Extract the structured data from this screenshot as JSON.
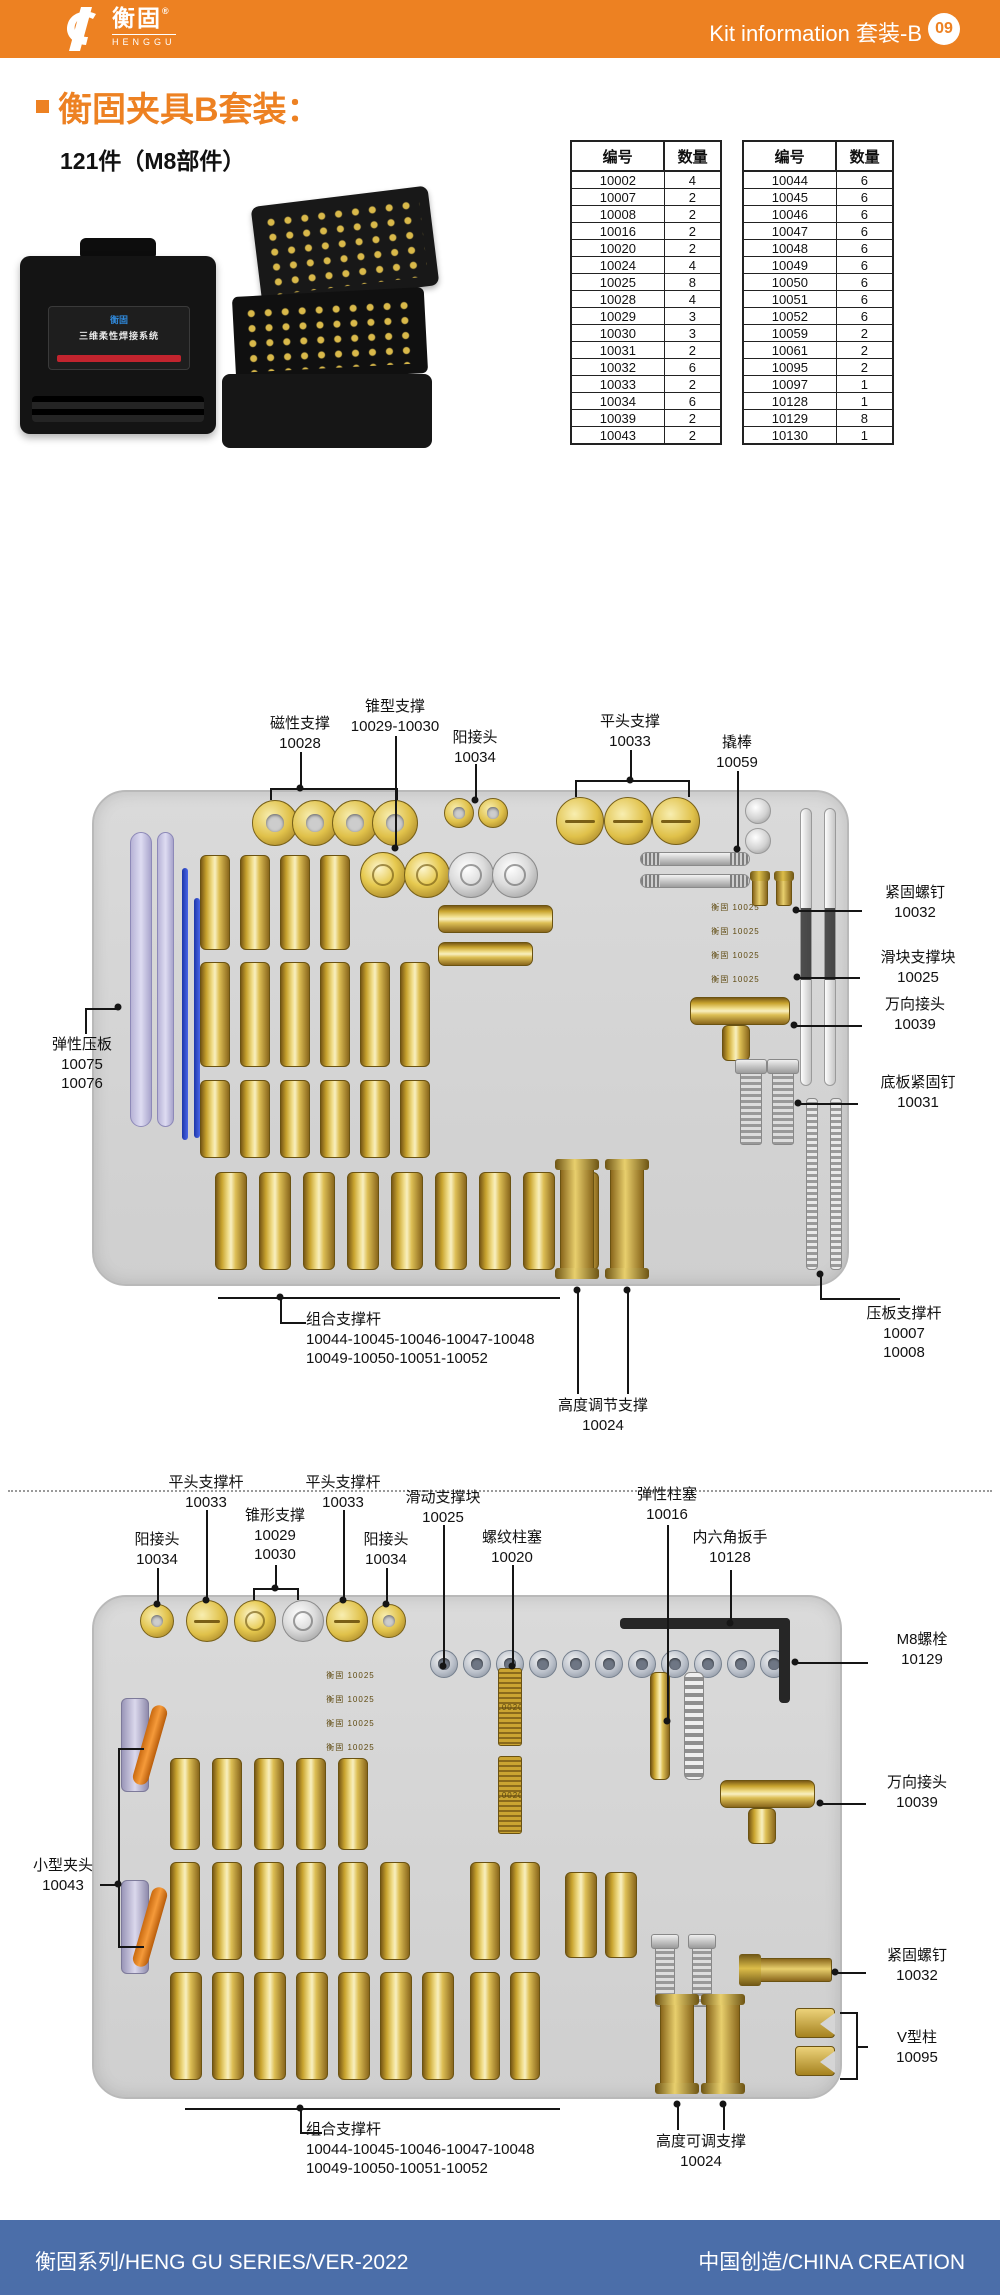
{
  "header": {
    "bg_color": "#ED8122",
    "brand_cn": "衡固",
    "registered_mark": "®",
    "brand_en": "HENGGU",
    "title": "Kit information 套装-B",
    "page_badge": "09"
  },
  "intro": {
    "accent_color": "#ED8122",
    "title": "衡固夹具B套装：",
    "subtitle": "121件（M8部件）"
  },
  "product_photos": {
    "closed_case_label": "三维柔性焊接系统"
  },
  "tables": {
    "headers": [
      "编号",
      "数量"
    ],
    "left_rows": [
      [
        "10002",
        "4"
      ],
      [
        "10007",
        "2"
      ],
      [
        "10008",
        "2"
      ],
      [
        "10016",
        "2"
      ],
      [
        "10020",
        "2"
      ],
      [
        "10024",
        "4"
      ],
      [
        "10025",
        "8"
      ],
      [
        "10028",
        "4"
      ],
      [
        "10029",
        "3"
      ],
      [
        "10030",
        "3"
      ],
      [
        "10031",
        "2"
      ],
      [
        "10032",
        "6"
      ],
      [
        "10033",
        "2"
      ],
      [
        "10034",
        "6"
      ],
      [
        "10039",
        "2"
      ],
      [
        "10043",
        "2"
      ]
    ],
    "right_rows": [
      [
        "10044",
        "6"
      ],
      [
        "10045",
        "6"
      ],
      [
        "10046",
        "6"
      ],
      [
        "10047",
        "6"
      ],
      [
        "10048",
        "6"
      ],
      [
        "10049",
        "6"
      ],
      [
        "10050",
        "6"
      ],
      [
        "10051",
        "6"
      ],
      [
        "10052",
        "6"
      ],
      [
        "10059",
        "2"
      ],
      [
        "10061",
        "2"
      ],
      [
        "10095",
        "2"
      ],
      [
        "10097",
        "1"
      ],
      [
        "10128",
        "1"
      ],
      [
        "10129",
        "8"
      ],
      [
        "10130",
        "1"
      ]
    ]
  },
  "diagram1": {
    "labels": {
      "magnetic": "磁性支撑\n10028",
      "cone": "锥型支撑\n10029-10030",
      "male_conn": "阳接头\n10034",
      "flat_head": "平头支撑\n10033",
      "pry_bar": "撬棒\n10059",
      "fasten_screw": "紧固螺钉\n10032",
      "slide_block": "滑块支撑块\n10025",
      "universal_joint": "万向接头\n10039",
      "base_pin": "底板紧固钉\n10031",
      "elastic_plate": "弹性压板\n10075\n10076",
      "combo_rod": "组合支撑杆\n10044-10045-10046-10047-10048\n10049-10050-10051-10052",
      "height_adjust": "高度调节支撑\n10024",
      "press_rod": "压板支撑杆\n10007\n10008"
    }
  },
  "diagram2": {
    "labels": {
      "flat_rod_1": "平头支撑杆\n10033",
      "cone": "锥形支撑\n10029\n10030",
      "flat_rod_2": "平头支撑杆\n10033",
      "male_conn_1": "阳接头\n10034",
      "male_conn_2": "阳接头\n10034",
      "slide_block": "滑动支撑块\n10025",
      "thread_plug": "螺纹柱塞\n10020",
      "spring_plunger": "弹性柱塞\n10016",
      "hex_wrench": "内六角扳手\n10128",
      "m8_bolt": "M8螺栓\n10129",
      "universal_joint": "万向接头\n10039",
      "fasten_screw": "紧固螺钉\n10032",
      "v_column": "V型柱\n10095",
      "small_clamp": "小型夹头\n10043",
      "combo_rod": "组合支撑杆\n10044-10045-10046-10047-10048\n10049-10050-10051-10052",
      "height_adjust": "高度可调支撑\n10024"
    }
  },
  "part_markings": {
    "slide_block": "衡固 10025",
    "thread_plug": "10020"
  },
  "footer": {
    "bg_color": "#4B6EA9",
    "left": "衡固系列/HENG GU SERIES/VER-2022",
    "right": "中国创造/CHINA CREATION"
  }
}
